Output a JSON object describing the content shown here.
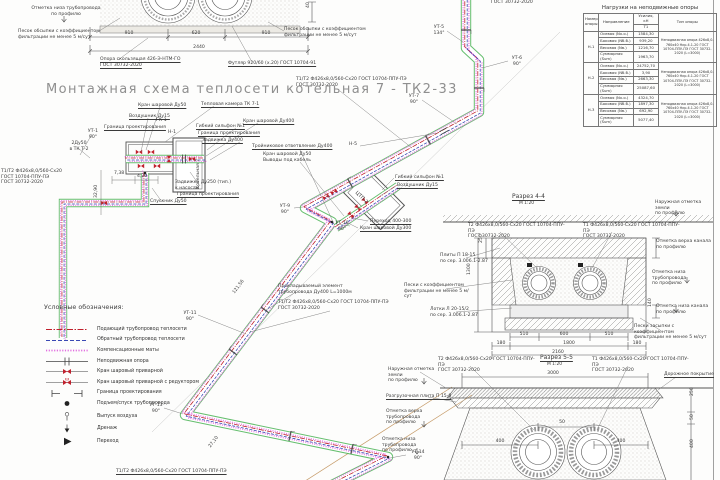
{
  "title": "Монтажная схема теплосети котельная 7 - ТК2-33",
  "colors": {
    "t1": "#c0202c",
    "t2": "#3a49b4",
    "channel": "#3fae4a",
    "mats": "#e26ee0",
    "line": "#555555",
    "title_gray": "#8f8f8f"
  },
  "loads_table": {
    "title": "Нагрузки на неподвижные опоры",
    "col_support": "Номер опоры",
    "col_direction": "Направление",
    "col_force": "Усилия, кН",
    "col_force_sub": "Т1",
    "col_type": "Тип опоры",
    "groups": [
      {
        "support": "Н-1",
        "rows": [
          [
            "Осевая (Nх.о.)",
            "1584,30"
          ],
          [
            "Боковая (Nб.б.)",
            "939,20"
          ],
          [
            "Весовая (Nв.)",
            "1216,70"
          ],
          [
            "Суммарная (Sum)",
            "1963,70"
          ]
        ],
        "type": "Неподвижная опора 426х8,0-760х40 Нкр.4.1-20 ГОСТ 10704-ППУ-ПЭ ГОСТ 30732-2020 (L=3000)"
      },
      {
        "support": "Н-2",
        "rows": [
          [
            "Осевая (Nх.о.)",
            "24752,70"
          ],
          [
            "Боковая (Nб.б.)",
            "3,90"
          ],
          [
            "Весовая (Nв.)",
            "2663,30"
          ],
          [
            "Суммарная (Sum)",
            "25087,60"
          ]
        ],
        "type": "Неподвижная опора 426х8,0-760х40 Нкр.4.1-20 ГОСТ 10704-ППУ-ПЭ ГОСТ 30732-2020 (L=3000)"
      },
      {
        "support": "Н-3",
        "rows": [
          [
            "Осевая (Nх.о.)",
            "4324,70"
          ],
          [
            "Боковая (Nб.б.)",
            "1897,30"
          ],
          [
            "Весовая (Nв.)",
            "692,90"
          ],
          [
            "Суммарная (Sum)",
            "5077,40"
          ]
        ],
        "type": "Неподвижная опора 426х8,0-760х40 Нкр.4.1-20 ГОСТ 10704-ППУ-ПЭ ГОСТ 30732-2020 (L=3000)"
      }
    ]
  },
  "legend": {
    "title": "Условные обозначения:",
    "items": [
      {
        "symbol": "t1-line",
        "label": "Подающий трубопровод теплосети"
      },
      {
        "symbol": "t2-line",
        "label": "Обратный трубопровод теплосети"
      },
      {
        "symbol": "mats-line",
        "label": "Компенсационные маты"
      },
      {
        "symbol": "fixed-support",
        "label": "Неподвижная опора"
      },
      {
        "symbol": "ball-valve",
        "label": "Кран шаровый приварной"
      },
      {
        "symbol": "ball-valve-gear",
        "label": "Кран шаровый приварной с редуктором"
      },
      {
        "symbol": "design-boundary",
        "label": "Граница проектирования"
      },
      {
        "symbol": "rise-point",
        "label": "Подъем/спуск трубопровода"
      },
      {
        "symbol": "air-outlet",
        "label": "Выпуск воздуха"
      },
      {
        "symbol": "drain",
        "label": "Дренаж"
      },
      {
        "symbol": "transition",
        "label": "Переход"
      }
    ]
  },
  "labels": [
    {
      "n": "main_title",
      "t": "Монтажная схема теплосети котельная 7 - ТК2-33"
    },
    {
      "n": "elev_low_tl",
      "t": "Отметка низа трубопровода\nпо профилю"
    },
    {
      "n": "sand_tl",
      "t": "Песок обсыпки с коэффициентом\nфильтрации не менее 5 м/сут"
    },
    {
      "n": "support_sliding",
      "t": "Опора скользящая 426-Э-НТМ-ГО\nГОСТ 30732-2020"
    },
    {
      "n": "futlyar",
      "t": "Футляр 920/60 (х.20) ГОСТ 10704-91"
    },
    {
      "n": "sand_tl2",
      "t": "Песок обсыпки с коэффициентом\nфильтрации не менее 5 м/сут"
    },
    {
      "n": "d910a",
      "t": "910"
    },
    {
      "n": "d620",
      "t": "620"
    },
    {
      "n": "d910b",
      "t": "910"
    },
    {
      "n": "d2440",
      "t": "2440"
    },
    {
      "n": "d40",
      "t": "40"
    },
    {
      "n": "gost_top",
      "t": "ГОСТ 30732-2020"
    },
    {
      "n": "spec_top",
      "t": "Т1/Т2 Ф426х8,0/560-Сх20 ГОСТ 10704-ППУ-ПЭ\nГОСТ 30732-2020"
    },
    {
      "n": "ut5",
      "t": "УТ-5\n134°"
    },
    {
      "n": "ut6",
      "t": "УТ-6\n90°"
    },
    {
      "n": "ut7",
      "t": "УТ-7\n90°"
    },
    {
      "n": "n5",
      "t": "Н-5"
    },
    {
      "n": "tee",
      "t": "Тройниковое ответвление Ду400"
    },
    {
      "n": "kran50_cable",
      "t": "Кран шаровой Ду50\nВыводы под кабель"
    },
    {
      "n": "ctp",
      "t": "ЦТП-2"
    },
    {
      "n": "gibkiy2",
      "t": "Гибкий сильфон №1"
    },
    {
      "n": "vozdushnik2",
      "t": "Воздушник Ду15"
    },
    {
      "n": "perehod",
      "t": "Переход 400-300"
    },
    {
      "n": "kran300",
      "t": "Кран шаровой Ду300"
    },
    {
      "n": "ut9",
      "t": "УТ-9\n90°"
    },
    {
      "n": "ut10",
      "t": "УТ-10\n90°"
    },
    {
      "n": "ut11",
      "t": "УТ-11\n90°"
    },
    {
      "n": "ut13",
      "t": "УТ-13\n90°"
    },
    {
      "n": "ut14",
      "t": "УТ-14\n90°"
    },
    {
      "n": "d2710",
      "t": "27,10"
    },
    {
      "n": "d12156",
      "t": "121,56"
    },
    {
      "n": "prokladka",
      "t": "Прокладываемый элемент\nтрубопровода Ду400 L=1000м"
    },
    {
      "n": "spec_mid",
      "t": "Т1/Т2 Ф426х8,0/560-Сх20 ГОСТ 10704-ППУ-ПЭ\nГОСТ 30732-2020"
    },
    {
      "n": "spec_bot",
      "t": "Т1/Т2 Ф426х8,0/560-Сх20 ГОСТ 10704-ППУ-ПЭ"
    },
    {
      "n": "d3290",
      "t": "32,90"
    },
    {
      "n": "d738",
      "t": "7,38"
    },
    {
      "n": "d420",
      "t": "4,20"
    },
    {
      "n": "b_kran50",
      "t": "Кран шаровой Ду50"
    },
    {
      "n": "b_vozd15",
      "t": "Воздушник Ду15"
    },
    {
      "n": "b_granica1",
      "t": "Граница проектирования"
    },
    {
      "n": "b_gk1",
      "t": "ГК-1"
    },
    {
      "n": "b_tk71",
      "t": "Тепловая камера ТК 7-1"
    },
    {
      "n": "b_kran400",
      "t": "Кран шаровой Ду400"
    },
    {
      "n": "b_n1",
      "t": "Н-1"
    },
    {
      "n": "b_gibkiy",
      "t": "Гибкий сильфон №1"
    },
    {
      "n": "b_granica2",
      "t": "Граница проектирования"
    },
    {
      "n": "b_zadv400",
      "t": "Задвижка Ду400"
    },
    {
      "n": "b_kotelnaya",
      "t": "Котельная 7"
    },
    {
      "n": "b_zadv250",
      "t": "Задвижка Ду250 (тип.)\nк насосам"
    },
    {
      "n": "b_granica3",
      "t": "Граница проектирования"
    },
    {
      "n": "b_spusknik",
      "t": "Спускник Ду50"
    },
    {
      "n": "b_2du50",
      "t": "2Ду50\nв ТК Т-2"
    },
    {
      "n": "b_ut1",
      "t": "УТ-1\n90°"
    },
    {
      "n": "spec_left",
      "t": "Т1/Т2 Ф426х8,0/560-Сх20\nГОСТ 10704-ППУ-ПЭ\nГОСТ 30732-2020"
    },
    {
      "n": "c44_title",
      "t": "Разрез 4-4"
    },
    {
      "n": "c44_scale",
      "t": "М 1:20"
    },
    {
      "n": "c44_ground",
      "t": "Наружная отметка земли\nпо профилю"
    },
    {
      "n": "c44_t2",
      "t": "Т2 Ф426х8,0/560-Сх20 ГОСТ 10704-ППУ-ПЭ\nГОСТ 30732-2020"
    },
    {
      "n": "c44_t1",
      "t": "Т1 Ф426х8,0/560-Сх20 ГОСТ 10704-ППУ-ПЭ\nГОСТ 30732-2020"
    },
    {
      "n": "c44_plity",
      "t": "Плиты П 18-15\nпо сер. 3.006.1-2.87"
    },
    {
      "n": "c44_peski",
      "t": "Пески с коэффициентом\nфильтрации не менее 5 м/сут"
    },
    {
      "n": "c44_lotki",
      "t": "Лотки Л 20-15/2\nпо сер. 3.006.1-2.87"
    },
    {
      "n": "c44_verh_kanala",
      "t": "Отметка верха канала\nпо профилю"
    },
    {
      "n": "c44_niz_trub",
      "t": "Отметка низа трубопровода\nпо профилю"
    },
    {
      "n": "c44_niz_kanala",
      "t": "Отметка низа канала\nпо профилю"
    },
    {
      "n": "c44_peski_zasypki",
      "t": "Пески засыпки с коэффициентом\nфильтрации не менее 5 м/сут"
    },
    {
      "n": "c44_d510a",
      "t": "510"
    },
    {
      "n": "c44_d600",
      "t": "600"
    },
    {
      "n": "c44_d510b",
      "t": "510"
    },
    {
      "n": "c44_d180a",
      "t": "180"
    },
    {
      "n": "c44_d1800",
      "t": "1800"
    },
    {
      "n": "c44_d180b",
      "t": "180"
    },
    {
      "n": "c44_d2160",
      "t": "2160"
    },
    {
      "n": "c44_d1300",
      "t": "1300"
    },
    {
      "n": "c44_d250",
      "t": "250"
    },
    {
      "n": "c44_d140",
      "t": "140"
    },
    {
      "n": "c55_title",
      "t": "Разрез 5-5"
    },
    {
      "n": "c55_scale",
      "t": "М 1:20"
    },
    {
      "n": "c55_t2",
      "t": "Т2 Ф426х8,0/560-Сх20 ГОСТ 10704-ППУ-ПЭ\nГОСТ 30732-2020"
    },
    {
      "n": "c55_t1",
      "t": "Т1 Ф426х8,0/560-Сх20 ГОСТ 10704-ППУ-ПЭ\nГОСТ 30732-2020"
    },
    {
      "n": "c55_ground",
      "t": "Наружная отметка земли\nпо профилю"
    },
    {
      "n": "c55_road",
      "t": "Дорожное покрытие"
    },
    {
      "n": "c55_plita",
      "t": "Разгрузочная плита П 15-8"
    },
    {
      "n": "c55_verh_trub",
      "t": "Отметка верха трубопровода\nпо профилю"
    },
    {
      "n": "c55_niz_trub",
      "t": "Отметка низа трубопровода\nпо профилю"
    },
    {
      "n": "c55_d3000",
      "t": "3000"
    },
    {
      "n": "c55_d400a",
      "t": "400"
    },
    {
      "n": "c55_d50",
      "t": "50"
    },
    {
      "n": "c55_d400b",
      "t": "400"
    },
    {
      "n": "c55_d250",
      "t": "250"
    },
    {
      "n": "c55_d50b",
      "t": "50"
    },
    {
      "n": "c55_d400c",
      "t": "400"
    }
  ]
}
